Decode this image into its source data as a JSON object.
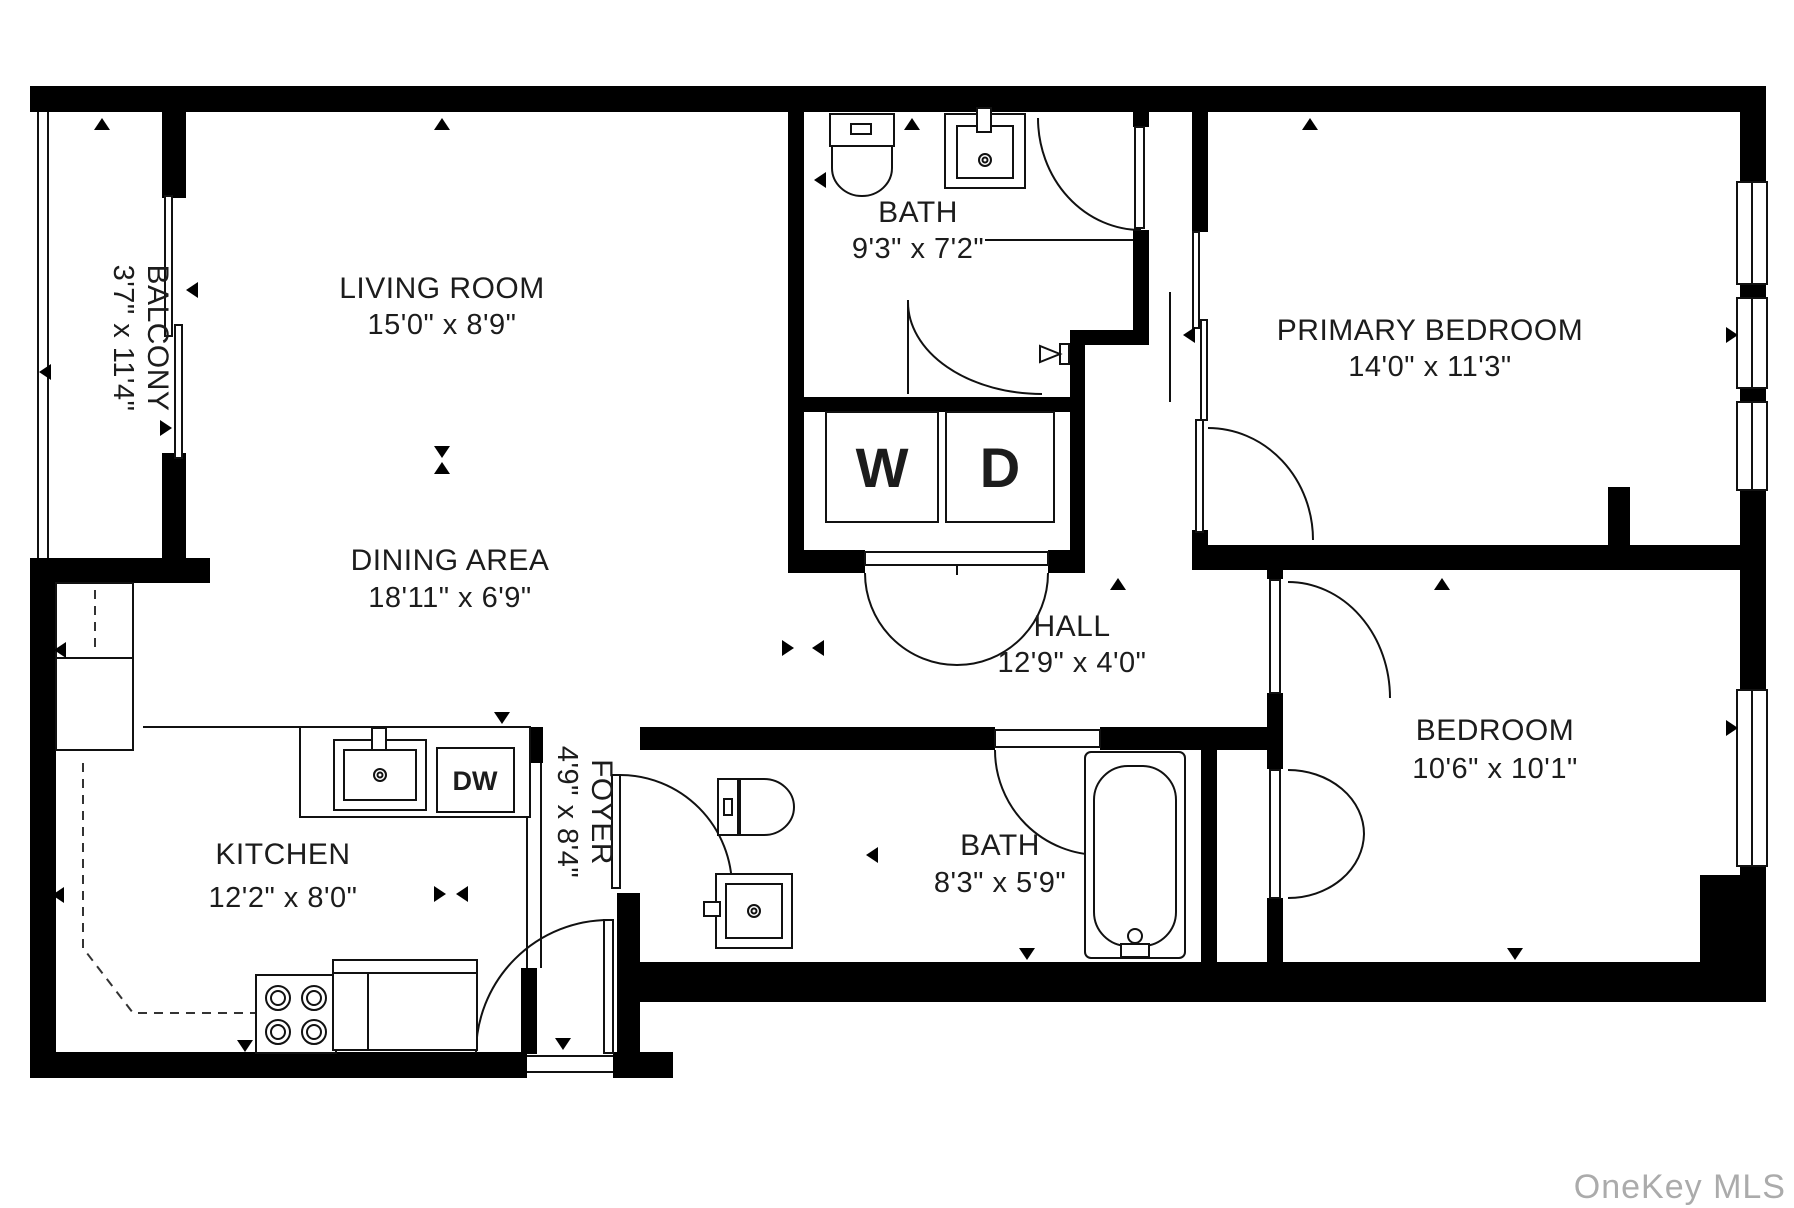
{
  "rooms": {
    "balcony": {
      "name": "BALCONY",
      "dims": "3'7\" x 11'4\""
    },
    "living": {
      "name": "LIVING ROOM",
      "dims": "15'0\" x 8'9\""
    },
    "dining": {
      "name": "DINING AREA",
      "dims": "18'11\" x 6'9\""
    },
    "bath1": {
      "name": "BATH",
      "dims": "9'3\" x 7'2\""
    },
    "primary": {
      "name": "PRIMARY BEDROOM",
      "dims": "14'0\" x 11'3\""
    },
    "hall": {
      "name": "HALL",
      "dims": "12'9\" x 4'0\""
    },
    "kitchen": {
      "name": "KITCHEN",
      "dims": "12'2\" x 8'0\""
    },
    "foyer": {
      "name": "FOYER",
      "dims": "4'9\" x 8'4\""
    },
    "bath2": {
      "name": "BATH",
      "dims": "8'3\" x 5'9\""
    },
    "bedroom": {
      "name": "BEDROOM",
      "dims": "10'6\" x 10'1\""
    }
  },
  "appliances": {
    "washer": "W",
    "dryer": "D",
    "dishwasher": "DW"
  },
  "watermark": "OneKey MLS",
  "colors": {
    "wall": "#000000",
    "label": "#1c1c1c",
    "watermark": "#ababab",
    "background": "#ffffff"
  }
}
